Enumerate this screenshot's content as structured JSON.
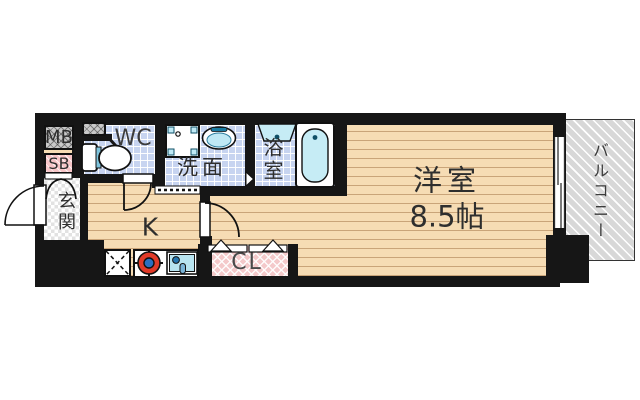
{
  "floorplan": {
    "type": "apartment-floor-plan",
    "rooms": {
      "meter_box": {
        "label": "MB"
      },
      "shaft_box": {
        "label": "SB"
      },
      "toilet": {
        "label": "WC"
      },
      "entrance": {
        "label": "玄関"
      },
      "washroom": {
        "label": "洗面"
      },
      "bathroom": {
        "label": "浴室"
      },
      "kitchen": {
        "label": "K"
      },
      "closet": {
        "label": "CL"
      },
      "main_room": {
        "label": "洋室",
        "size": "8.5帖"
      },
      "balcony": {
        "label": "バルコニー"
      }
    },
    "icons": [
      "toilet-icon",
      "washing-machine-icon",
      "basin-icon",
      "bathtub-icon",
      "vanity-icon",
      "gas-stove-icon",
      "kitchen-sink-icon",
      "refrigerator-space-icon",
      "door-swing-icon",
      "sliding-window-icon",
      "closet-door-icon"
    ],
    "colors": {
      "wall": "#161616",
      "wood_floor": "#f6dcb4",
      "wood_line": "#c9a479",
      "tile_blue": "#c7d4f0",
      "pink": "#f4c9ca",
      "gray_hatch": "#c9c9c9",
      "balcony_gray": "#d8d8d8",
      "fixture_cyan": "#c6ecf5",
      "stove_red": "#e13a28",
      "stove_blue": "#2b6fc0",
      "text": "#2e2e2e"
    }
  }
}
